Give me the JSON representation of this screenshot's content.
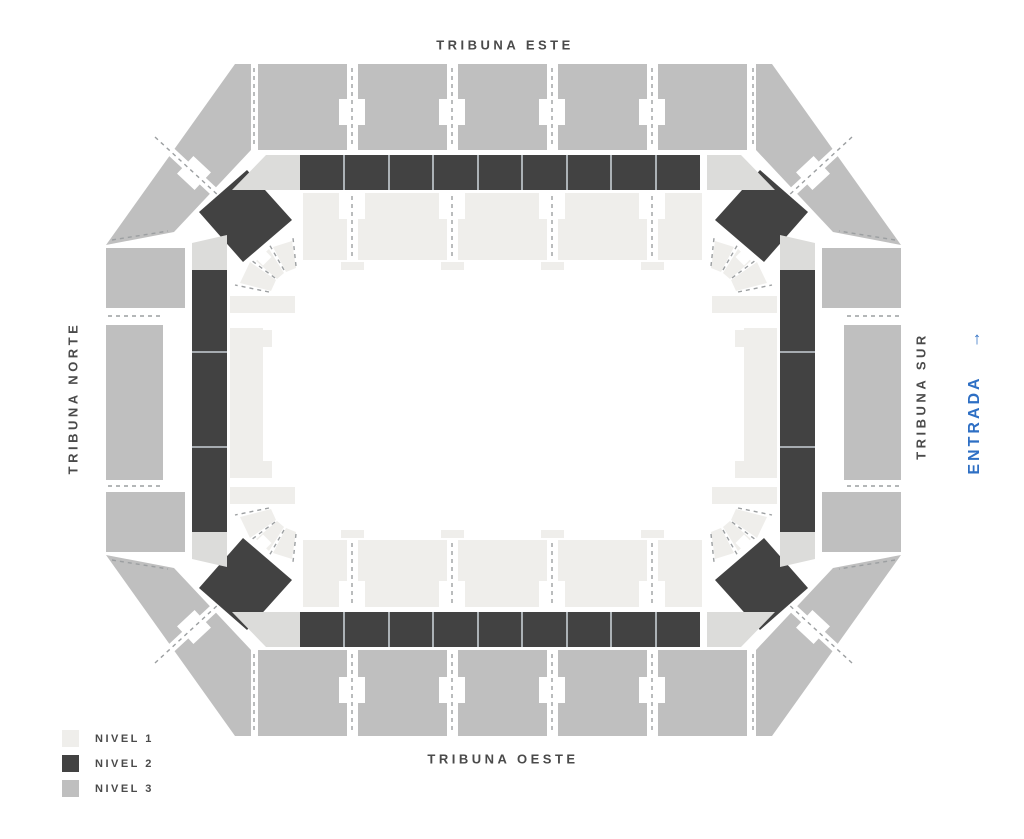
{
  "labels": {
    "este": "TRIBUNA ESTE",
    "norte": "TRIBUNA NORTE",
    "sur": "TRIBUNA SUR",
    "oeste": "TRIBUNA OESTE"
  },
  "entrance": {
    "label": "ENTRADA",
    "arrow": "↑",
    "color": "#2e6fc4"
  },
  "legend": {
    "items": [
      {
        "label": "NIVEL 1",
        "color": "#efeeeb"
      },
      {
        "label": "NIVEL 2",
        "color": "#424242"
      },
      {
        "label": "NIVEL 3",
        "color": "#bfbfbf"
      }
    ]
  },
  "colors": {
    "connector": "#dcdcda",
    "aisle_dash": "#9c9fa1",
    "cell_divider": "#c8ced4",
    "background": "#ffffff"
  }
}
